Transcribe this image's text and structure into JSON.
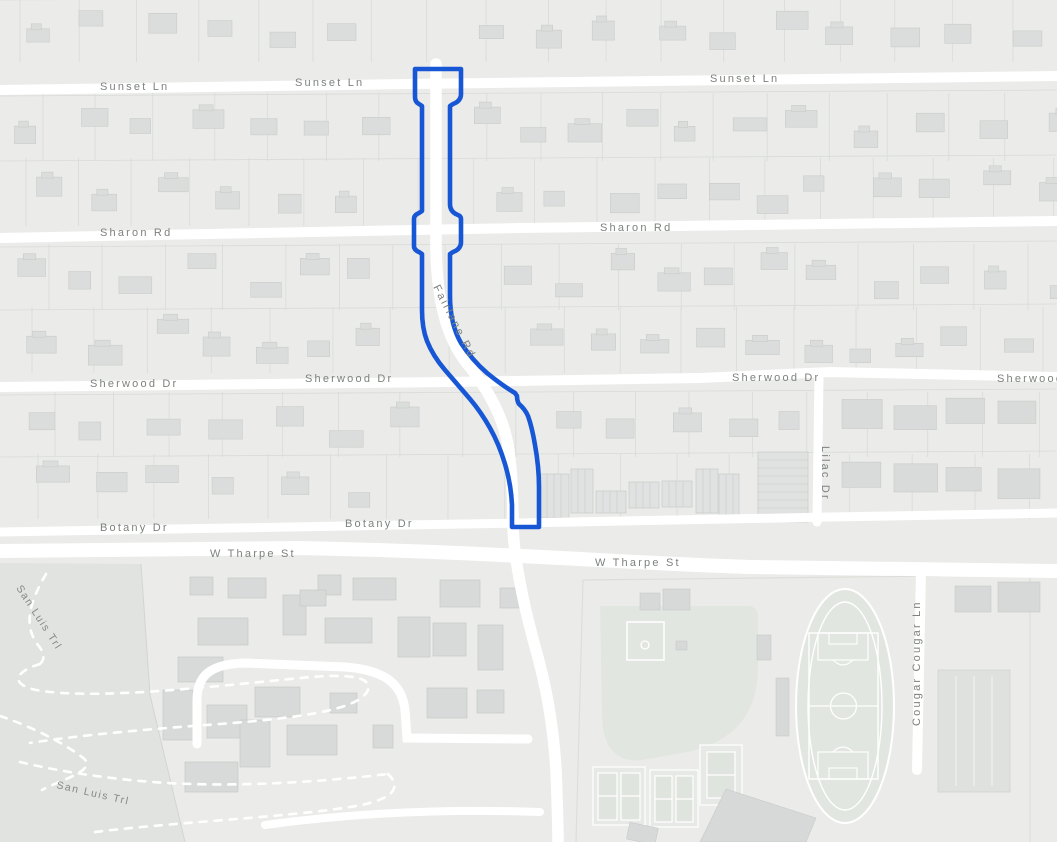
{
  "map": {
    "kind": "street-map-with-highlighted-route",
    "route": {
      "name": "Fairlane Rd",
      "color": "#1757d6",
      "extent": "Fairlane Rd between Sunset Ln and Botany Dr"
    },
    "labels": {
      "sunset": "Sunset Ln",
      "sharon": "Sharon Rd",
      "sherwood": "Sherwood Dr",
      "botany": "Botany Dr",
      "tharpe": "W Tharpe St",
      "fairlane": "Fairlane Rd",
      "lilac": "Lilac Dr",
      "cougar": "Cougar Cougar Ln",
      "san_luis": "San Luis Trl"
    },
    "colors": {
      "route": "#1757d6",
      "road": "#ffffff",
      "background": "#ebece9",
      "label_text": "#7d827e",
      "park": "#e0e3df",
      "sports_field": "#e2e6e1",
      "building": "#d9dcda"
    }
  }
}
